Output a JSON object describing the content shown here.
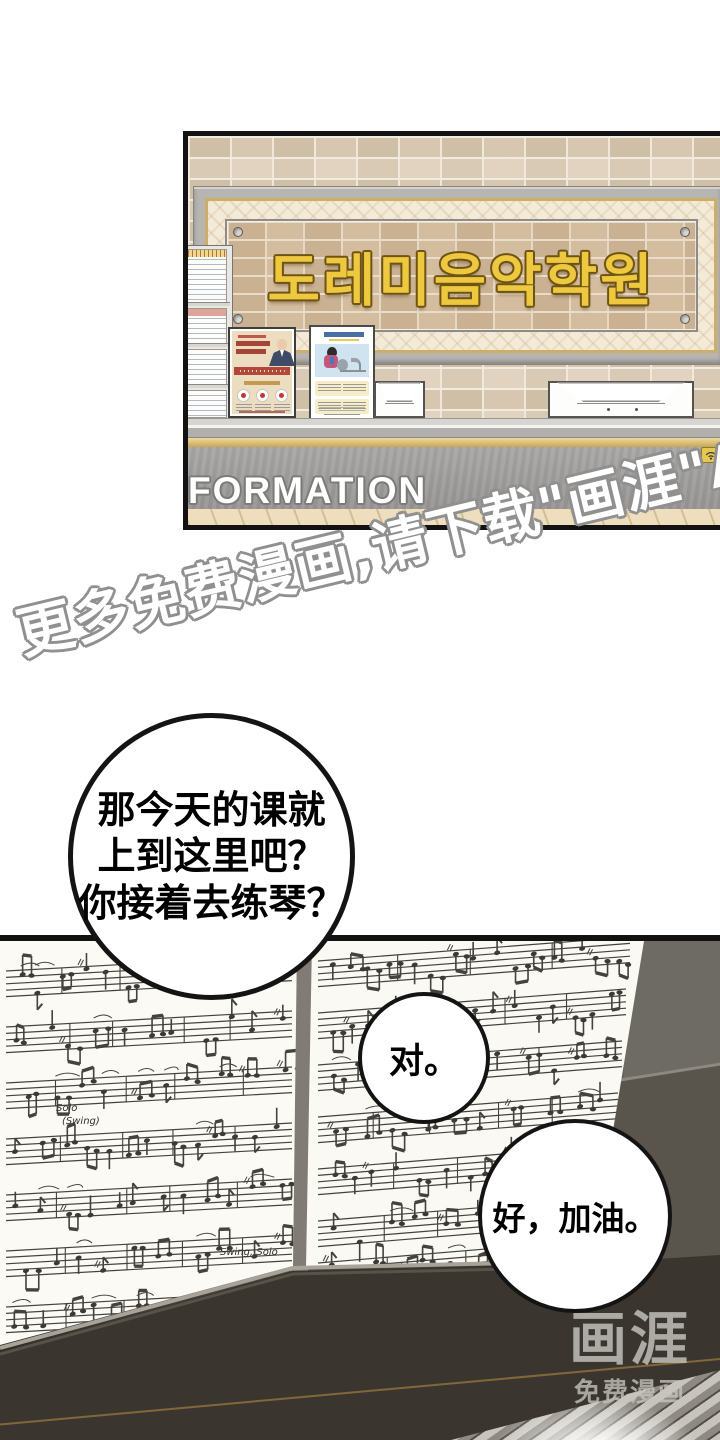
{
  "panel1": {
    "sign": {
      "text": "도레미음악학원"
    },
    "counter": {
      "label": "FORMATION"
    }
  },
  "watermark": {
    "diagonal_text": "更多免费漫画,请下载\"画涯\"APP。",
    "logo_text": "画涯",
    "logo_tagline": "免费漫画"
  },
  "bubbles": {
    "main_line1": "那今天的课就",
    "main_line2": "上到这里吧？",
    "main_line3": "你接着去练琴？",
    "reply_short": "对。",
    "reply_long": "好，加油。"
  },
  "sheet": {
    "annotation_1": "Solo",
    "annotation_2": "(Swing)",
    "annotation_3": "Swing, Solo"
  },
  "colors": {
    "sign_gold": "#eec83e",
    "brick": "#d9c6af",
    "counter_gray": "#9d9c9a",
    "gold_stripe": "#d8bd7e",
    "piano_dark": "#37342e",
    "watermark_outline": "#909090",
    "logo_gray": "#c6c4bf"
  }
}
